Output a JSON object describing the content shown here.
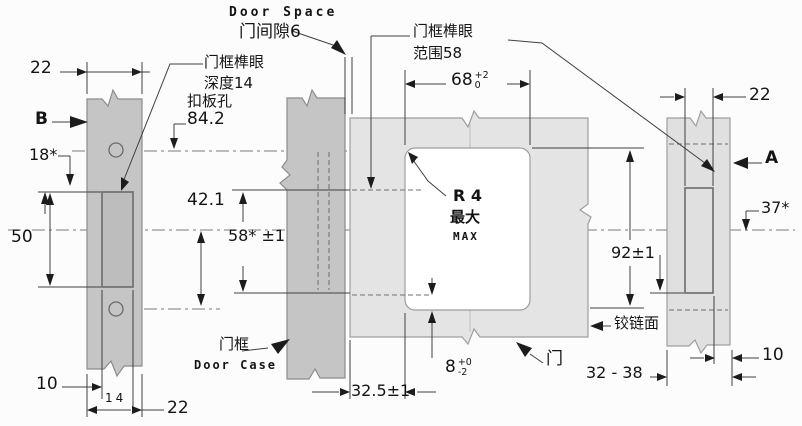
{
  "colors": {
    "bar_dark": "#c5c5c5",
    "bar_dark_mortise": "#bdbdbd",
    "bar_light": "#e0e0e0",
    "panel": "#e4e4e4",
    "window": "#ffffff",
    "line": "#3f3f3f",
    "background": "#fcfcfc"
  },
  "callouts": {
    "door_space": {
      "en": "Door Space",
      "cn": "门间隙6"
    },
    "frame_mortise_depth": {
      "line1": "门框榫眼",
      "line2": "深度14"
    },
    "catch_plate": {
      "name": "扣板孔",
      "value": "84.2"
    },
    "frame_mortise_range": {
      "line1": "门框榫眼",
      "line2": "范围58"
    },
    "door_case": {
      "cn": "门框",
      "en": "Door Case"
    },
    "door": {
      "cn": "门"
    },
    "hinge_face": {
      "cn": "铰链面"
    },
    "corner_radius": {
      "line1": "R 4",
      "line2": "最大",
      "line3": "MAX"
    }
  },
  "dims": {
    "left_width_top": "22",
    "view_b": "B",
    "left_offset": "18*",
    "left_mortise_height": "50",
    "left_inset": "10",
    "left_mortise_width": "14",
    "left_width_bottom": "22",
    "case_to_top": "42.1",
    "case_mortise": "58* ±1",
    "case_setback": "32.5±1",
    "panel_width_main": "68",
    "panel_width_sup": "+2",
    "panel_width_sub": "0",
    "panel_depth_main": "8",
    "panel_depth_sup": "+0",
    "panel_depth_sub": "-2",
    "panel_height": "92±1",
    "panel_range": "32 - 38",
    "right_width_top": "22",
    "view_a": "A",
    "right_offset": "37*",
    "right_inset": "10"
  }
}
